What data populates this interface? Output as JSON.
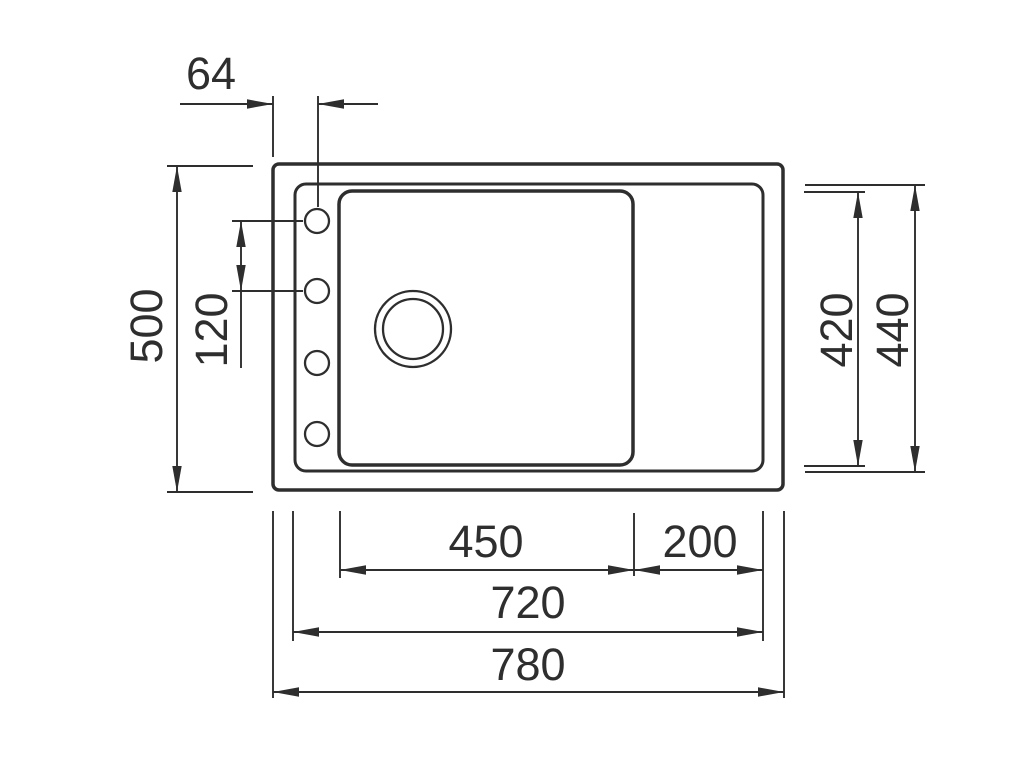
{
  "drawing": {
    "type": "technical-dimension-drawing",
    "subject": "kitchen sink top view with bowl, drainer and faucet holes",
    "background": "#ffffff",
    "line_color": "#2e2e2e",
    "labels": {
      "hole_offset_top": "64",
      "overall_depth": "500",
      "hole_spacing": "120",
      "bowl_depth": "420",
      "inner_depth": "440",
      "bowl_width": "450",
      "drainer_width": "200",
      "inner_width": "720",
      "overall_width": "780"
    }
  }
}
